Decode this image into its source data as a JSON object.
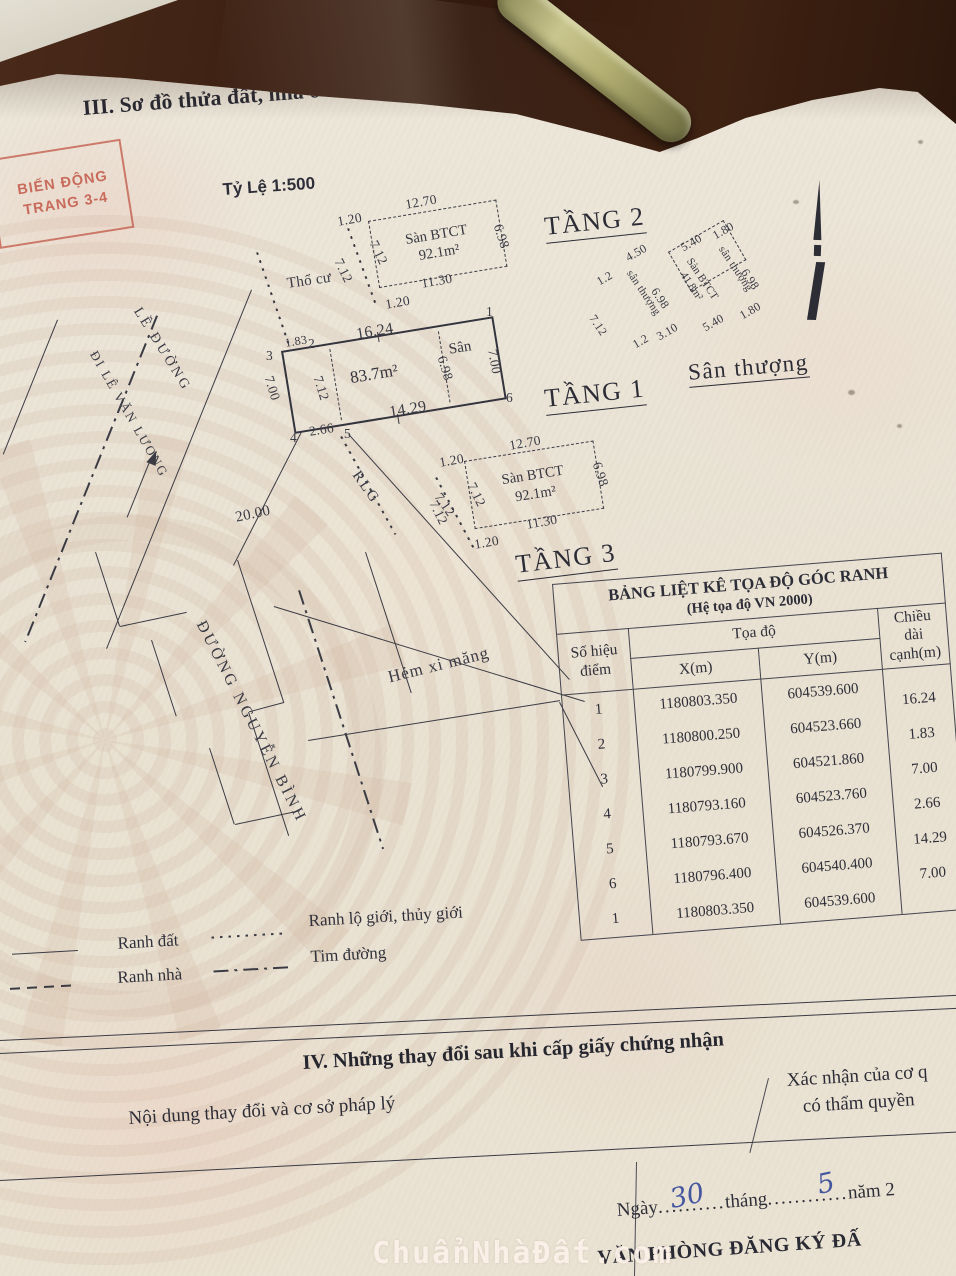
{
  "header": {
    "section_title": "III. Sơ đồ thửa đất, nhà ở và tài sản khác gắn liền với đất",
    "scale_label": "Tỷ Lệ 1:500",
    "stamp_line1": "BIẾN ĐỘNG",
    "stamp_line2": "TRANG 3-4",
    "pencil_note": "1916218"
  },
  "floors": {
    "tang2": {
      "label": "TẦNG 2",
      "material": "Sàn BTCT",
      "area": "92.1m²",
      "dims": {
        "top_offset": "1.20",
        "top": "12.70",
        "left_inner": "7.12",
        "left_outer": "7.12",
        "right": "6.98",
        "bottom": "11.30",
        "bottom_offset": "1.20"
      }
    },
    "tang1": {
      "label": "TẦNG 1",
      "area": "83.7m²",
      "yard": "Sân",
      "dims": {
        "top": "16.24",
        "top_left": "1.83",
        "left": "7.00",
        "left_inner": "7.12",
        "yard_width": "6.98",
        "right": "7.00",
        "bottom": "14.29",
        "bottom_left": "2.66"
      },
      "points": {
        "p1": "1",
        "p2": "2",
        "p3": "3",
        "p4": "4",
        "p5": "5",
        "p6": "6"
      }
    },
    "san_thuong": {
      "label": "Sân thượng",
      "material": "Sàn BTCT",
      "area": "41.8m²",
      "side_left": "sân thượng",
      "side_right": "sân thượng",
      "dims": {
        "d450": "4.50",
        "d540_top": "5.40",
        "d180_top": "1.80",
        "d698_left": "6.98",
        "d698_right": "6.98",
        "d12_left": "1.2",
        "d712": "7.12",
        "d12_bottom": "1.2",
        "d310": "3.10",
        "d540_bottom": "5.40",
        "d180_bottom": "1.80"
      }
    },
    "tang3": {
      "label": "TẦNG 3",
      "material": "Sàn BTCT",
      "area": "92.1m²",
      "dims": {
        "top_offset": "1.20",
        "top": "12.70",
        "left_inner": "7.12",
        "left_outer": "7.12",
        "right": "6.98",
        "bottom": "11.30",
        "bottom_offset": "1.20"
      }
    }
  },
  "site": {
    "tho_cu": "Thổ cư",
    "rlg": "RLG",
    "d712": "7.12",
    "le_duong": "LỀ ĐƯỜNG",
    "di_le_van_luong": "ĐI LÊ VĂN LƯƠNG",
    "duong_nguyen_binh": "ĐƯỜNG NGUYỄN BÌNH",
    "hem_xi_mang": "Hẻm xi măng",
    "d2000": "20.00"
  },
  "coord_table": {
    "title": "BẢNG LIỆT KÊ TỌA ĐỘ GÓC RANH",
    "subtitle": "(Hệ tọa độ VN 2000)",
    "col_point_1": "Số hiệu",
    "col_point_2": "điểm",
    "col_coord": "Tọa độ",
    "col_x": "X(m)",
    "col_y": "Y(m)",
    "col_len_1": "Chiều dài",
    "col_len_2": "cạnh(m)",
    "rows": [
      [
        "1",
        "1180803.350",
        "604539.600",
        "16.24"
      ],
      [
        "2",
        "1180800.250",
        "604523.660",
        "1.83"
      ],
      [
        "3",
        "1180799.900",
        "604521.860",
        "7.00"
      ],
      [
        "4",
        "1180793.160",
        "604523.760",
        "2.66"
      ],
      [
        "5",
        "1180793.670",
        "604526.370",
        "14.29"
      ],
      [
        "6",
        "1180796.400",
        "604540.400",
        "7.00"
      ],
      [
        "1",
        "1180803.350",
        "604539.600",
        ""
      ]
    ]
  },
  "legend": {
    "ranh_dat": "Ranh đất",
    "ranh_nha": "Ranh nhà",
    "ranh_lo_gioi": "Ranh lộ giới, thủy giới",
    "tim_duong": "Tim đường"
  },
  "section4": {
    "title": "IV. Những thay đổi sau khi cấp giấy chứng nhận",
    "col_content": "Nội dung thay đổi và cơ sở pháp lý",
    "col_confirm_line1": "Xác nhận của cơ q",
    "col_confirm_line2": "có thẩm quyền"
  },
  "footer": {
    "ngay": "Ngày",
    "dots1": "..........",
    "day": "30",
    "thang": "tháng",
    "dots2": "............",
    "month": "5",
    "nam": "năm 2",
    "office": "VĂN PHÒNG ĐĂNG KÝ ĐẤ",
    "watermark": "ChuẩnNhàĐất.com"
  }
}
